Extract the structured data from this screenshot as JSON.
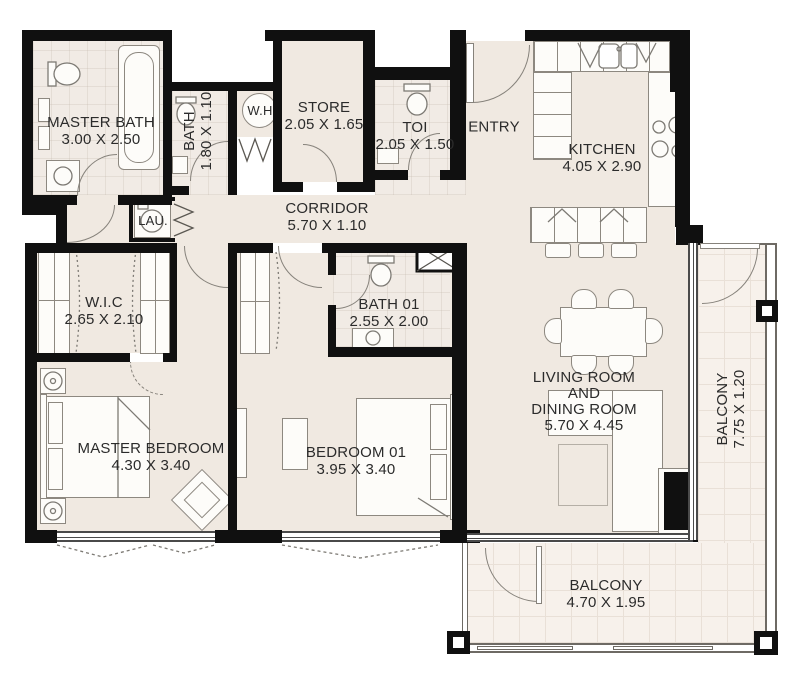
{
  "plan": {
    "title": "Apartment floor plan",
    "colors": {
      "walls": "#101010",
      "floor": "#f0e9e1",
      "balcony_floor": "#f7f1eb",
      "furniture_stroke": "#8d8880",
      "text": "#2b2b2b"
    },
    "rooms": [
      {
        "id": "master-bath",
        "name": "MASTER BATH",
        "dims": "3.00 X 2.50"
      },
      {
        "id": "bath",
        "name": "BATH",
        "dims": "1.80 X 1.10"
      },
      {
        "id": "water-heater",
        "name": "W.H",
        "dims": ""
      },
      {
        "id": "store",
        "name": "STORE",
        "dims": "2.05 X 1.65"
      },
      {
        "id": "toilet",
        "name": "TOI",
        "dims": "2.05 X 1.50"
      },
      {
        "id": "entry",
        "name": "ENTRY",
        "dims": ""
      },
      {
        "id": "kitchen",
        "name": "KITCHEN",
        "dims": "4.05 X 2.90"
      },
      {
        "id": "laundry",
        "name": "LAU.",
        "dims": ""
      },
      {
        "id": "corridor",
        "name": "CORRIDOR",
        "dims": "5.70 X 1.10"
      },
      {
        "id": "walk-in-closet",
        "name": "W.I.C",
        "dims": "2.65 X 2.10"
      },
      {
        "id": "bath-01",
        "name": "BATH 01",
        "dims": "2.55 X 2.00"
      },
      {
        "id": "living-dining",
        "name_lines": [
          "LIVING ROOM",
          "AND",
          "DINING ROOM"
        ],
        "dims": "5.70 X 4.45"
      },
      {
        "id": "master-bedroom",
        "name": "MASTER BEDROOM",
        "dims": "4.30 X 3.40"
      },
      {
        "id": "bedroom-01",
        "name": "BEDROOM 01",
        "dims": "3.95 X 3.40"
      },
      {
        "id": "balcony-side",
        "name": "BALCONY",
        "dims": "7.75 X 1.20"
      },
      {
        "id": "balcony-bottom",
        "name": "BALCONY",
        "dims": "4.70 X 1.95"
      }
    ]
  }
}
